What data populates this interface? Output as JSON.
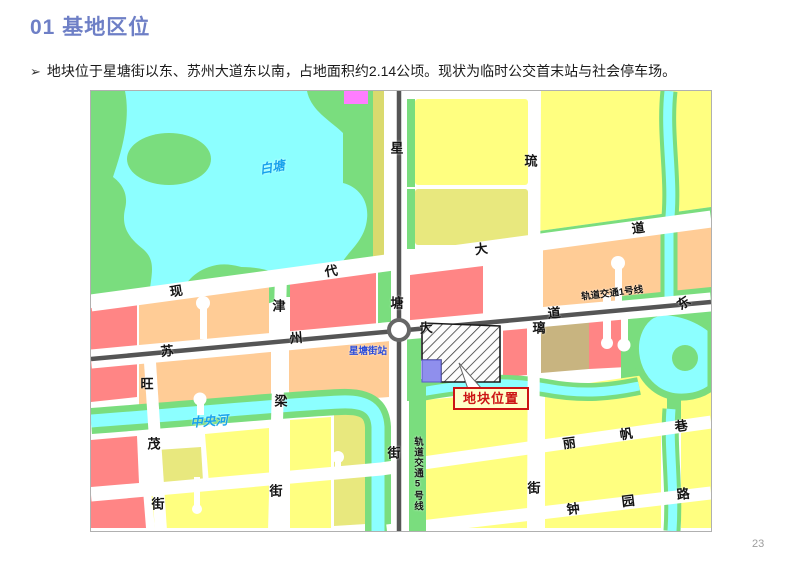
{
  "slide": {
    "title": "01 基地区位",
    "bullet_marker": "➢",
    "bullet_text": "地块位于星塘街以东、苏州大道东以南，占地面积约2.14公顷。现状为临时公交首末站与社会停车场。",
    "page_number": "23"
  },
  "map": {
    "water_labels": {
      "lake": "白塘",
      "river": "中央河"
    },
    "station_label": "星塘街站",
    "rail_labels": {
      "line1": "轨道交通1号线",
      "line5": "轨道交通5号线"
    },
    "site_label": "地块位置",
    "streets": {
      "xiandai": [
        "现",
        "代",
        "大",
        "道"
      ],
      "suzhou": [
        "苏",
        "州",
        "大",
        "道",
        "东"
      ],
      "xingtang": [
        "星",
        "塘",
        "街"
      ],
      "jinliang": [
        "津",
        "梁",
        "街"
      ],
      "liuli": [
        "琉",
        "璃",
        "街"
      ],
      "wangmao": [
        "旺",
        "茂",
        "街"
      ],
      "lifan": [
        "丽",
        "帆",
        "巷"
      ],
      "zhongyuan": [
        "钟",
        "园",
        "路"
      ]
    },
    "colors": {
      "title_blue": "#6E7FC6",
      "block_yellow": "#FFFF80",
      "block_olive": "#E8E87E",
      "block_red": "#FF8585",
      "block_orange": "#FFCC96",
      "block_tan": "#C8B480",
      "block_magenta": "#FF7DFF",
      "park_green": "#7ADD7E",
      "water_cyan": "#8CFFFF",
      "rail_gray": "#555555",
      "site_purple": "#8F8FED",
      "callout_bg": "#FFFFC8",
      "callout_red": "#CC1414",
      "water_text_blue": "#17A2EC",
      "station_text_blue": "#2B4BD8"
    }
  }
}
